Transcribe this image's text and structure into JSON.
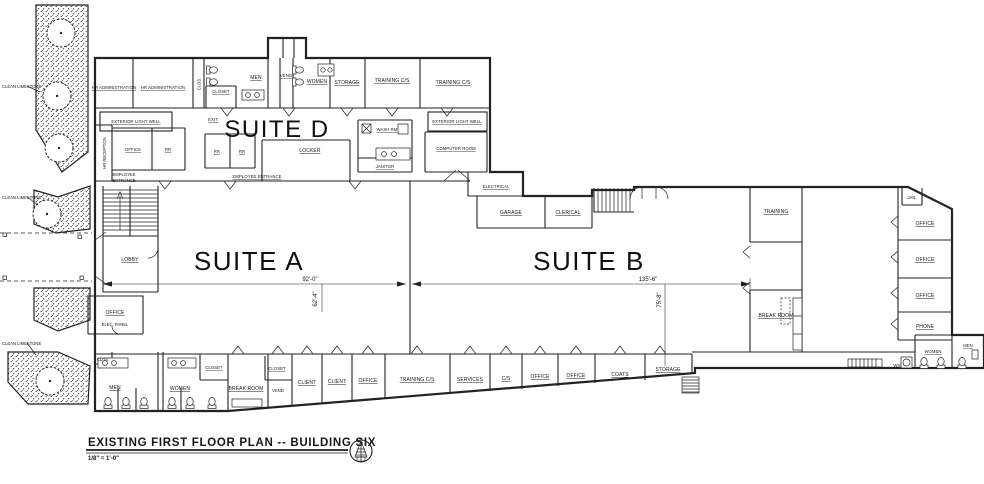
{
  "title_block": {
    "title": "EXISTING FIRST FLOOR PLAN -- BUILDING SIX",
    "scale": "1/8\" = 1'-0\""
  },
  "suites": {
    "a": "SUITE A",
    "b": "SUITE B",
    "d": "SUITE D"
  },
  "site": {
    "limestone_labels": [
      "CLEAN LIMESTONE",
      "CLEAN LIMESTONE",
      "CLEAN LIMESTONE"
    ]
  },
  "annotations": {
    "light_well_left": "EXTERIOR LIGHT WELL",
    "light_well_right": "EXTERIOR LIGHT WELL",
    "employee_entrance_line1": "EMPLOYEE",
    "employee_entrance_line2": "ENTRANCE",
    "employee_entrance_center": "EMPLOYEE ENTRANCE",
    "exit": "EXIT"
  },
  "dimensions": {
    "suite_a_width": "92'-0\"",
    "suite_a_depth": "62'-4\"",
    "suite_b_width": "135'-6\"",
    "suite_b_depth": "75'-8\""
  },
  "rooms": {
    "top_row": [
      "HR ADMINISTRATION",
      "HR ADMINISTRATION",
      "CLOS.",
      "MEN",
      "CLOSET",
      "VEND",
      "WOMEN",
      "STORAGE",
      "TRAINING C/S",
      "TRAINING C/S"
    ],
    "suite_d": {
      "hr_reception": "HR RECEPTION",
      "office": "OFFICE",
      "rr_a": "RR",
      "rr_b": "RR",
      "rr_c": "RR",
      "locker": "LOCKER",
      "wash_rm": "WASH RM",
      "janitor": "JANITOR",
      "computer_room": "COMPUTER ROOM"
    },
    "core_west": {
      "lobby": "LOBBY",
      "office": "OFFICE",
      "elec_panel": "ELEC. PANEL"
    },
    "restrooms_west": {
      "clos": "CLOS.",
      "men": "MEN",
      "women": "WOMEN",
      "closet": "CLOSET"
    },
    "bottom_row": [
      "BREAK ROOM",
      "CLOSET",
      "VEND",
      "CLIENT",
      "CLIENT",
      "OFFICE",
      "TRAINING C/S",
      "SERVICES",
      "C/S",
      "OFFICE",
      "OFFICE",
      "COATS",
      "STORAGE"
    ],
    "suite_b_core": {
      "electrical": "ELECTRICAL",
      "garage": "GARAGE",
      "clerical": "CLERICAL"
    },
    "east_wing": {
      "training": "TRAINING",
      "break_room": "BREAK ROOM",
      "jan": "JAN.",
      "offices": [
        "OFFICE",
        "OFFICE",
        "OFFICE",
        "PHONE"
      ],
      "women": "WOMEN",
      "men": "MEN",
      "water_heater": "WH"
    }
  },
  "colors": {
    "ink": "#222222",
    "paper": "#ffffff"
  }
}
